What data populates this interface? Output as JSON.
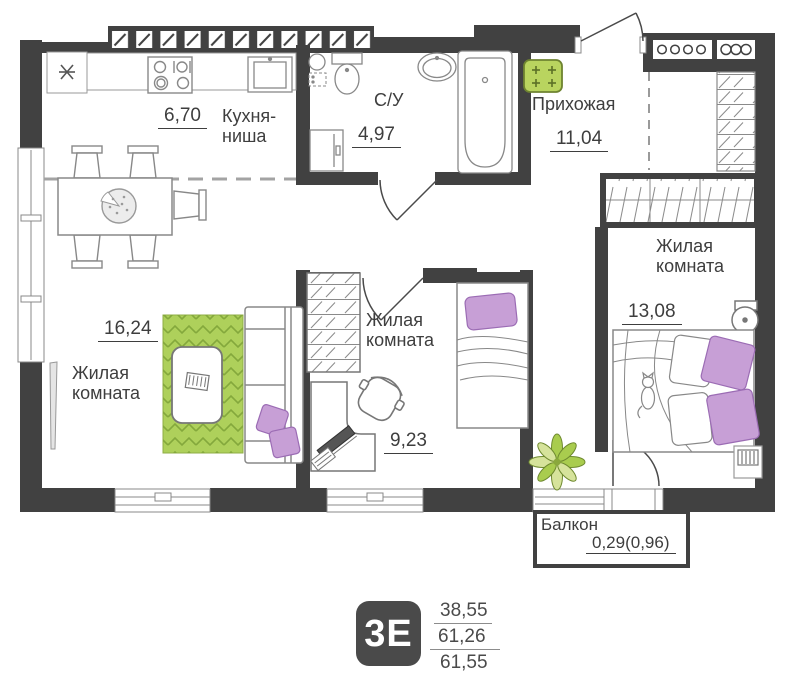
{
  "plan": {
    "rooms": {
      "kitchen": {
        "name": "Кухня-ниша",
        "area": "6,70"
      },
      "bathroom": {
        "name": "С/У",
        "area": "4,97"
      },
      "hallway": {
        "name": "Прихожая",
        "area": "11,04"
      },
      "living_main": {
        "name": "Жилая комната",
        "area": "16,24"
      },
      "living_middle": {
        "name": "Жилая комната",
        "area": "9,23"
      },
      "living_right": {
        "name": "Жилая комната",
        "area": "13,08"
      },
      "balcony": {
        "name": "Балкон",
        "area": "0,29(0,96)"
      }
    },
    "legend": {
      "type_badge": "3Е",
      "living_area": "38,55",
      "area_no_balcony": "61,26",
      "total_area": "61,55"
    },
    "colors": {
      "wall": "#414141",
      "rug_green": "#aed05b",
      "mat_green": "#b9d45f",
      "accent_purple": "#c79fd6",
      "text": "#3e3e3e"
    }
  }
}
